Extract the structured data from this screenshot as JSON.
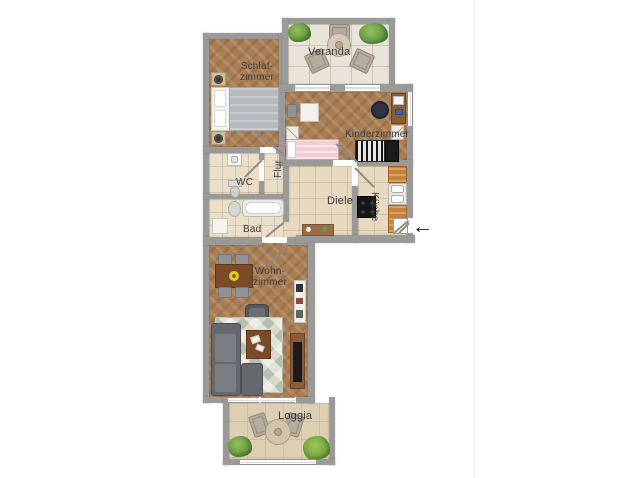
{
  "floorplan": {
    "rooms": {
      "veranda": {
        "label": "Veranda"
      },
      "schlafzimmer": {
        "label_line1": "Schlaf-",
        "label_line2": "zimmer"
      },
      "kinderzimmer": {
        "label": "Kinderzimmer"
      },
      "wc": {
        "label": "WC"
      },
      "flur": {
        "label": "Flur"
      },
      "diele": {
        "label": "Diele"
      },
      "kueche": {
        "label": "Küche"
      },
      "bad": {
        "label": "Bad"
      },
      "wohnzimmer": {
        "label_line1": "Wohn-",
        "label_line2": "zimmer"
      },
      "loggia": {
        "label": "Loggia"
      }
    },
    "entrance": {
      "arrow_glyph": "←"
    },
    "colors": {
      "wall": "#9a9a98",
      "wood_floor": "#a97e54",
      "tile_floor": "#ecdfc8",
      "veranda_floor": "#e9e4d9",
      "loggia_floor": "#ddcfb4",
      "kitchen_counter": "#c6813c",
      "label_text": "#3b3b3b"
    }
  }
}
